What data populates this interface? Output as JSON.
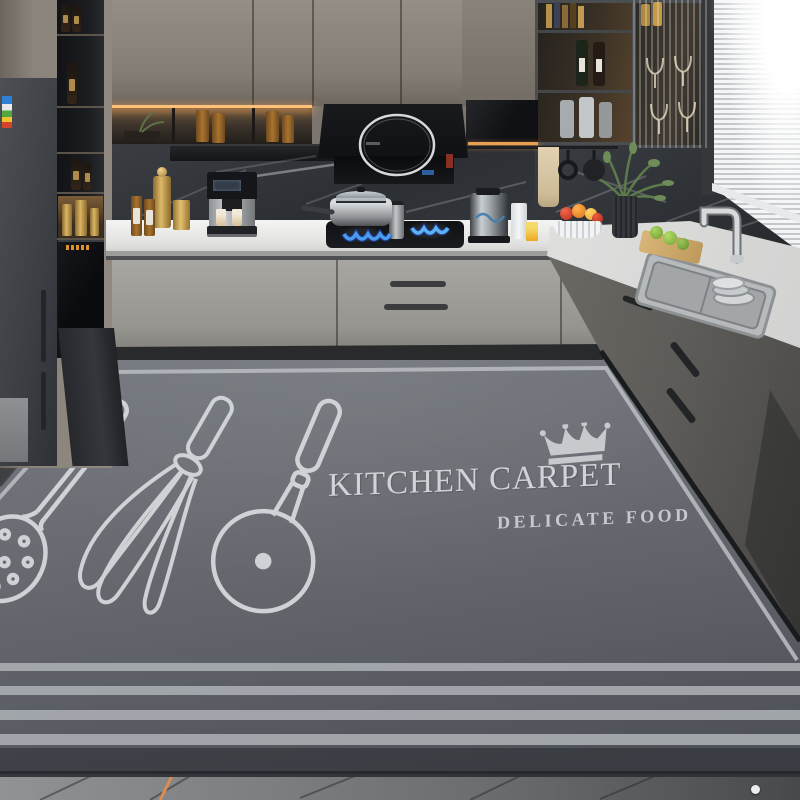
{
  "product": {
    "title": "KITCHEN CARPET",
    "subtitle": "DELICATE FOOD",
    "brand_mark": "crown"
  },
  "carpet": {
    "stripe_count": 4,
    "motifs": [
      "crown-icon",
      "skimmer-icon",
      "whisk-icon",
      "pizza-cutter-icon"
    ],
    "colors": {
      "base": "#6f7379",
      "shadow": "#53565c",
      "stripe": "#a7abb0",
      "border_line": "#b5b9be",
      "text": "#d0d3d7"
    }
  },
  "scene": {
    "accent_colors": {
      "led_warm": "#ffc078",
      "flame_blue": "#4b9bf0",
      "gold": "#d9b564",
      "towel_beige": "#e2d2b2",
      "lime_green": "#85b545",
      "fruit_red": "#d8432e",
      "fruit_orange": "#e8862c"
    }
  }
}
